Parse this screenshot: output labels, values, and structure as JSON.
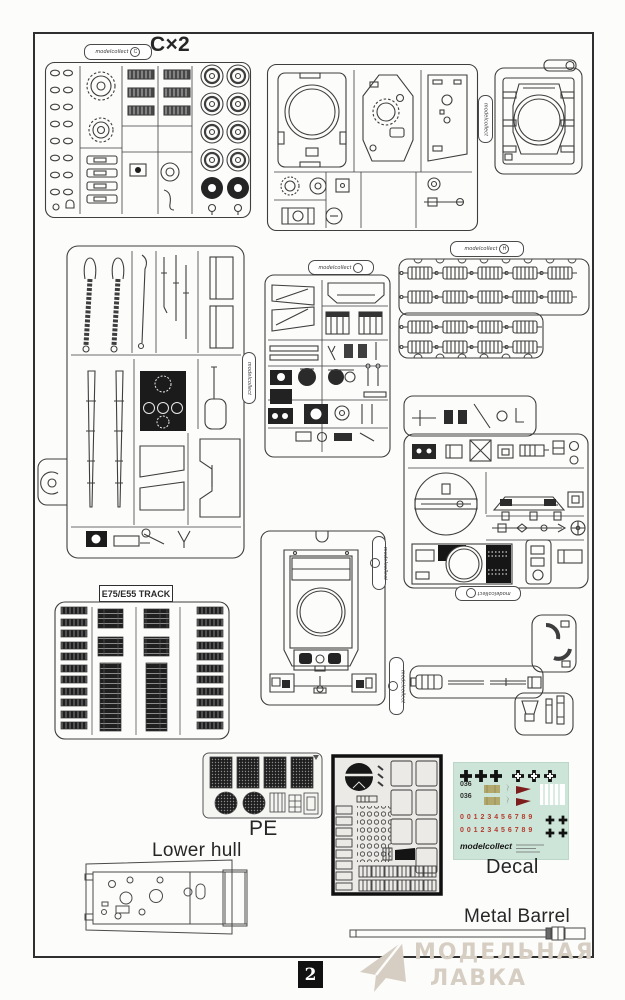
{
  "brand": "modelcollect",
  "page": {
    "number": "2"
  },
  "labels": {
    "sprue_c": "C×2",
    "track": "E75/E55 TRACK",
    "pe": "PE",
    "lower_hull": "Lower hull",
    "decal": "Decal",
    "metal_barrel": "Metal Barrel"
  },
  "tags": {
    "c_letter": "C",
    "h_letter": "H"
  },
  "decal_sheet": {
    "brand": "modelcollect",
    "code_1": "036",
    "code_2": "036",
    "digits_1": "0 0 1 2 3 4 5 6 7 8 9",
    "digits_2": "0 0 1 2 3 4 5 6 7 8 9"
  },
  "watermark": {
    "line1": "МОДЕЛЬНАЯ",
    "line2": "ЛАВКА"
  },
  "colors": {
    "ink": "#3e3e3e",
    "dark_fill": "#1c1c1c",
    "decal_bg": "#cde5d8",
    "decal_red": "#b5392c",
    "decal_tan": "#b3a96d",
    "watermark": "#d6cec2"
  }
}
